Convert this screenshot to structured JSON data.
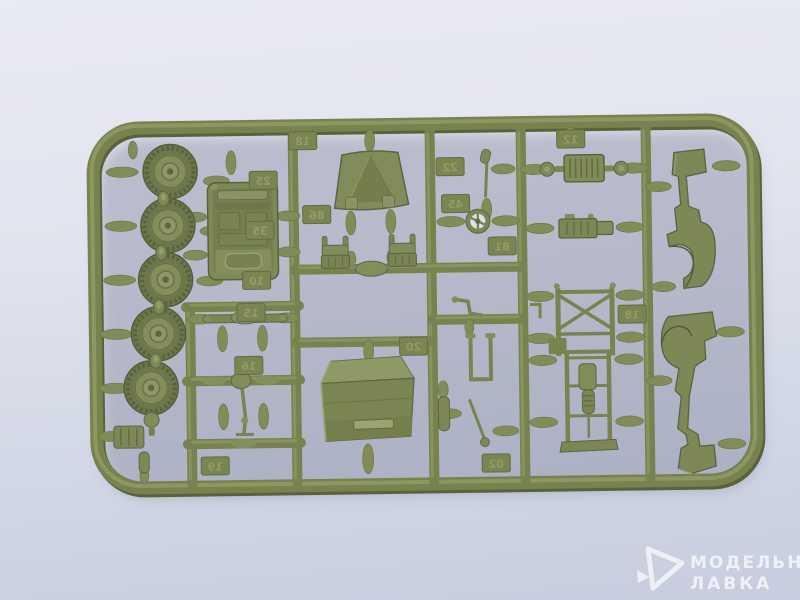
{
  "photo": {
    "subject": "plastic-model-kit-sprue",
    "colors": {
      "background_top": "#e9eaf3",
      "background_bottom": "#c7cdde",
      "plastic_base": "#78824e",
      "plastic_light": "#939c68",
      "plastic_dark": "#59623c",
      "shadow": "rgba(96,102,128,0.32)",
      "watermark": "#ffffff"
    }
  },
  "watermark": {
    "logo": "modelnaya-lavka-logo",
    "line1": "МОДЕЛЬНАЯ",
    "line2": "ЛАВКА"
  },
  "sprue": {
    "plastic_color": "#78824e",
    "parts": [
      "tire-wheel x5",
      "hub-knob x4",
      "jeep-body-tub",
      "windshield-frame",
      "seat x2",
      "seat-cushion",
      "storage-box",
      "radiator-grille",
      "headlight x2",
      "engine-block",
      "chassis-frame-x-brace",
      "chassis-with-drivetrain",
      "body-side-panel x2",
      "axle-with-leaf-springs x3",
      "drive-shaft",
      "steering-wheel",
      "gear-lever",
      "crank-handle",
      "u-bracket",
      "muffler",
      "steering-column",
      "jerry-can",
      "filler-cap"
    ],
    "tags": [
      {
        "label": "25"
      },
      {
        "label": "35"
      },
      {
        "label": "10"
      },
      {
        "label": "15"
      },
      {
        "label": "16"
      },
      {
        "label": "19"
      },
      {
        "label": "18"
      },
      {
        "label": "22"
      },
      {
        "label": "45"
      },
      {
        "label": "81"
      },
      {
        "label": "20"
      },
      {
        "label": "02"
      },
      {
        "label": "18"
      },
      {
        "label": "12"
      },
      {
        "label": "86"
      }
    ]
  }
}
